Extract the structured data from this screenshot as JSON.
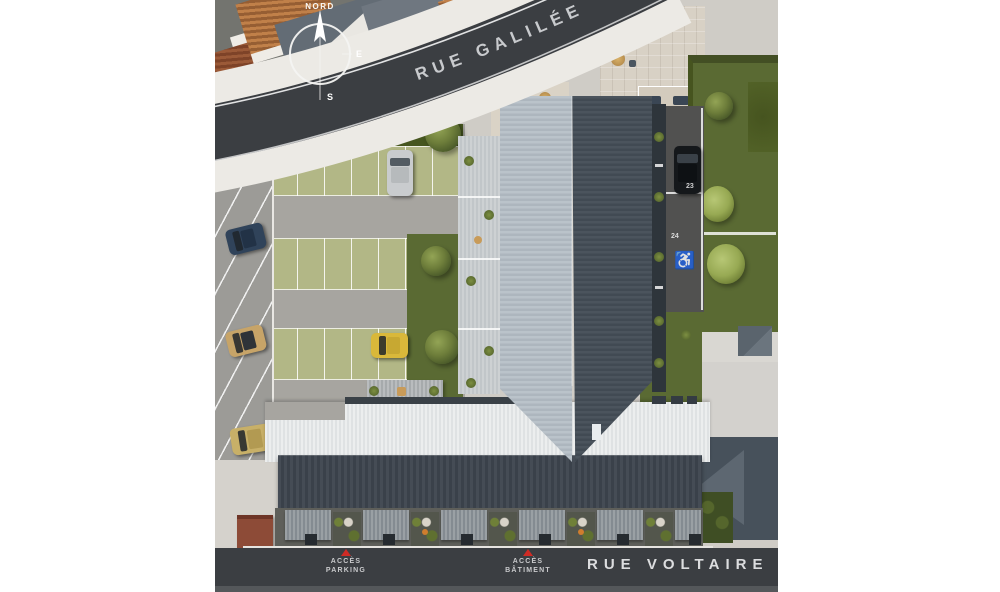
{
  "scene": {
    "type": "architectural-site-plan-aerial-render",
    "description": "Top-down 3D render of a residential building plot between two streets"
  },
  "streets": {
    "galilee": "RUE GALILÉE",
    "voltaire": "RUE VOLTAIRE"
  },
  "compass": {
    "north_label": "NORD",
    "east": "E",
    "south": "S"
  },
  "access": {
    "parking_line1": "ACCÈS",
    "parking_line2": "PARKING",
    "batiment_line1": "ACCÈS",
    "batiment_line2": "BÂTIMENT"
  },
  "parking": {
    "stall_22": "22",
    "stall_23": "23",
    "stall_24": "24",
    "handicap_icon": "♿"
  },
  "colors": {
    "street": "#3b3e42",
    "street_text": "#c8cacd",
    "asphalt_parking": "#9c9b97",
    "grass": "#5a6a33",
    "grass_pavers": "#b2b786",
    "roof_light_slope": "#b6bfc7",
    "roof_dark_slope": "#49525a",
    "roof_white_band": "#e8eaea",
    "roof_dark_band": "#3e454d",
    "terracotta": "#b5713c",
    "beige_plaza": "#d7d0c3",
    "neighbor_roof": "#46515b",
    "accent_red": "#cf2b25"
  }
}
